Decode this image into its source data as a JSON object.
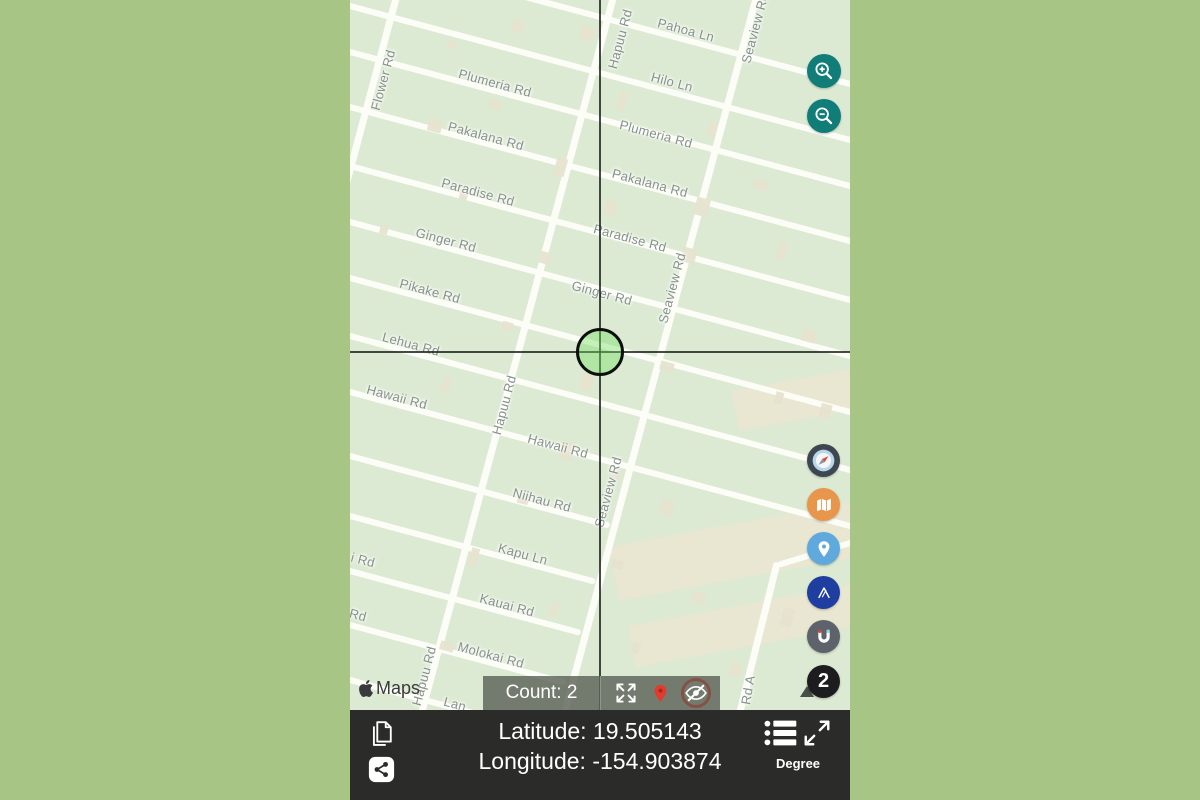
{
  "map": {
    "attribution_logo": "apple-icon",
    "attribution_text": "Maps",
    "streets": [
      {
        "text": "Pahoa Ln",
        "x": 336,
        "y": 30,
        "rot": 15
      },
      {
        "text": "Hilo Ln",
        "x": 322,
        "y": 82,
        "rot": 15
      },
      {
        "text": "Plumeria Rd",
        "x": 306,
        "y": 134,
        "rot": 15
      },
      {
        "text": "Pakalana Rd",
        "x": 300,
        "y": 183,
        "rot": 15
      },
      {
        "text": "Paradise Rd",
        "x": 280,
        "y": 238,
        "rot": 15
      },
      {
        "text": "Ginger Rd",
        "x": 252,
        "y": 293,
        "rot": 15
      },
      {
        "text": "Plumeria Rd",
        "x": 145,
        "y": 83,
        "rot": 15
      },
      {
        "text": "Pakalana Rd",
        "x": 136,
        "y": 136,
        "rot": 15
      },
      {
        "text": "Paradise Rd",
        "x": 128,
        "y": 192,
        "rot": 15
      },
      {
        "text": "Ginger Rd",
        "x": 96,
        "y": 240,
        "rot": 15
      },
      {
        "text": "Pikake Rd",
        "x": 80,
        "y": 291,
        "rot": 15
      },
      {
        "text": "Lehua Rd",
        "x": 61,
        "y": 344,
        "rot": 15
      },
      {
        "text": "Hawaii Rd",
        "x": 47,
        "y": 397,
        "rot": 15
      },
      {
        "text": "Hawaii Rd",
        "x": 208,
        "y": 446,
        "rot": 15
      },
      {
        "text": "Niihau Rd",
        "x": 192,
        "y": 500,
        "rot": 15
      },
      {
        "text": "Kapu Ln",
        "x": 173,
        "y": 554,
        "rot": 15
      },
      {
        "text": "Kauai Rd",
        "x": 157,
        "y": 605,
        "rot": 15
      },
      {
        "text": "Molokai Rd",
        "x": 141,
        "y": 655,
        "rot": 15
      },
      {
        "text": "i Rd",
        "x": 13,
        "y": 560,
        "rot": 15
      },
      {
        "text": "Rd",
        "x": 8,
        "y": 615,
        "rot": 15
      },
      {
        "text": "Lan",
        "x": 105,
        "y": 704,
        "rot": 15
      },
      {
        "text": "Flower Rd",
        "x": 33,
        "y": 80,
        "rot": -75
      },
      {
        "text": "Hapuu Rd",
        "x": 270,
        "y": 39,
        "rot": -75
      },
      {
        "text": "Hapuu Rd",
        "x": 154,
        "y": 405,
        "rot": -75
      },
      {
        "text": "Hapuu Rd",
        "x": 74,
        "y": 676,
        "rot": -75
      },
      {
        "text": "Seaview Rd",
        "x": 405,
        "y": 28,
        "rot": -75
      },
      {
        "text": "Seaview Rd",
        "x": 322,
        "y": 288,
        "rot": -75
      },
      {
        "text": "Seaview Rd",
        "x": 258,
        "y": 492,
        "rot": -75
      },
      {
        "text": "Rd A",
        "x": 398,
        "y": 690,
        "rot": -80
      }
    ]
  },
  "controls": {
    "zoom_in_icon": "magnifier-plus",
    "zoom_out_icon": "magnifier-minus",
    "side_buttons": [
      {
        "name": "compass-button",
        "icon": "compass-icon",
        "bg": "#3e4651"
      },
      {
        "name": "map-style-button",
        "icon": "folded-map-icon",
        "bg": "#e9964d"
      },
      {
        "name": "location-pin-button",
        "icon": "pin-icon",
        "bg": "#5fa9dd"
      },
      {
        "name": "navigation-button",
        "icon": "mountain-icon",
        "bg": "#1e3ea0"
      },
      {
        "name": "magnet-button",
        "icon": "magnet-u-icon",
        "bg": "#5e626b"
      },
      {
        "name": "count-badge",
        "label": "2",
        "bg": "#1d1d1f"
      }
    ]
  },
  "overlay_bar": {
    "count_label": "Count: 2",
    "icons": [
      "expand-icon",
      "red-pin-icon",
      "eye-slash-icon"
    ]
  },
  "bottom_bar": {
    "latitude": "Latitude: 19.505143",
    "longitude": "Longitude: -154.903874",
    "unit_label": "Degree",
    "icons": [
      "copy-icon",
      "share-icon",
      "list-icon",
      "resize-icon"
    ]
  },
  "colors": {
    "background": "#a7c585",
    "map_background": "#dcead3",
    "road": "#fdfdf8",
    "field": "#e9e6d1",
    "teal_zoom": "#107d79",
    "overlay_bar": "rgba(92,99,88,0.82)",
    "bottom_bar": "#2b2b29",
    "red_pin": "#e23b2e",
    "crosshair": "#191c19"
  }
}
